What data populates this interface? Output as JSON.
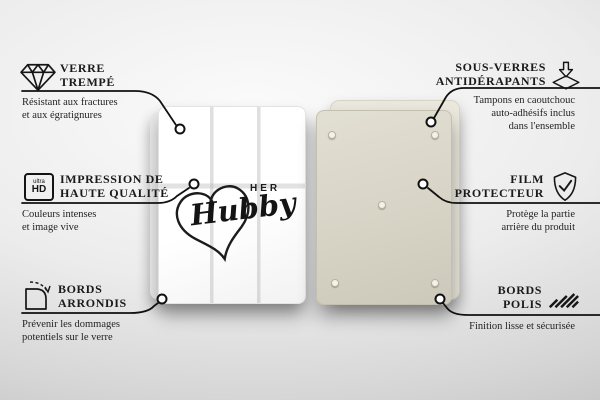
{
  "product": {
    "front_design": {
      "word_top": "HER",
      "word_main": "Hubby"
    },
    "ultra_hd_badge": {
      "top": "ultra",
      "bottom": "HD"
    }
  },
  "features": {
    "left": [
      {
        "icon": "diamond-icon",
        "title1": "VERRE",
        "title2": "TREMPÉ",
        "desc1": "Résistant aux fractures",
        "desc2": "et aux égratignures"
      },
      {
        "icon": "ultra-hd-icon",
        "title1": "IMPRESSION DE",
        "title2": "HAUTE QUALITÉ",
        "desc1": "Couleurs intenses",
        "desc2": "et image vive"
      },
      {
        "icon": "rounded-corner-icon",
        "title1": "BORDS",
        "title2": "ARRONDIS",
        "desc1": "Prévenir les dommages",
        "desc2": "potentiels sur le verre"
      }
    ],
    "right": [
      {
        "icon": "anti-slip-pads-icon",
        "title1": "SOUS-VERRES",
        "title2": "ANTIDÉRAPANTS",
        "desc1": "Tampons en caoutchouc",
        "desc2": "auto-adhésifs inclus",
        "desc3": "dans l'ensemble"
      },
      {
        "icon": "shield-check-icon",
        "title1": "FILM",
        "title2": "PROTECTEUR",
        "desc1": "Protège la partie",
        "desc2": "arrière du produit"
      },
      {
        "icon": "polished-edges-icon",
        "title1": "BORDS",
        "title2": "POLIS",
        "desc1": "Finition lisse et sécurisée"
      }
    ]
  },
  "colors": {
    "line": "#111111",
    "text": "#1a1a1a",
    "panel_front": "#ffffff",
    "panel_back": "#d7d4c6",
    "background_light": "#fbfbfb",
    "background_dark": "#bfbfbf"
  }
}
